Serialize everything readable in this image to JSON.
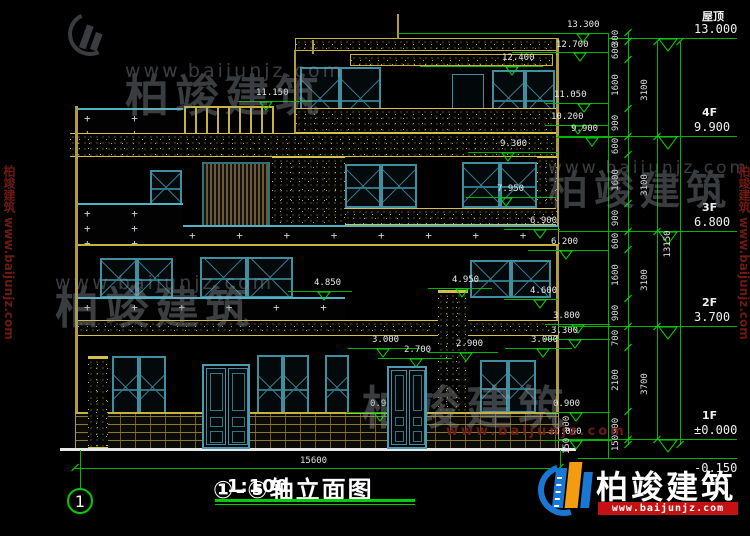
{
  "title_block": {
    "title": "①-⑤轴立面图",
    "scale": "1:100"
  },
  "axis_bubble": {
    "label": "1"
  },
  "bottom_dimension": {
    "label": "15600"
  },
  "pattern_plus": "+",
  "watermark": {
    "cn": "柏竣建筑",
    "url": "www.baijunjz.com"
  },
  "logo": {
    "cn": "柏竣建筑",
    "url": "www.baijunjz.com"
  },
  "colors": {
    "dim_green": "#00b400",
    "cad_yellow": "#b09c3c",
    "window_teal": "#3f8fa0",
    "logo_blue": "#1976d2",
    "logo_orange": "#f39c12",
    "logo_red": "#c41111"
  },
  "annotations": {
    "floor_levels": [
      {
        "name": "屋顶",
        "elev": "13.000",
        "y": 38,
        "lead_x1": 608,
        "tri": true
      },
      {
        "name": "4F",
        "elev": "9.900",
        "y": 136,
        "lead_x1": 558,
        "tri": true
      },
      {
        "name": "3F",
        "elev": "6.800",
        "y": 231,
        "lead_x1": 558,
        "tri": true
      },
      {
        "name": "2F",
        "elev": "3.700",
        "y": 326,
        "lead_x1": 558,
        "tri": true
      },
      {
        "name": "1F",
        "elev": "±0.000",
        "y": 439,
        "lead_x1": 558,
        "tri": true
      },
      {
        "name": "",
        "elev": "-0.150",
        "y": 458,
        "lead_x1": 578,
        "tri": false,
        "below": true
      }
    ],
    "elevation_markers": [
      {
        "l": "13.300",
        "y": 33,
        "x1": 398,
        "x2": 608,
        "tx": 567,
        "ty": 20,
        "mx": 583
      },
      {
        "l": "12.700",
        "y": 52,
        "x1": 512,
        "x2": 608,
        "tx": 556,
        "ty": 40,
        "mx": 580
      },
      {
        "l": "12.400",
        "y": 66,
        "x1": 420,
        "x2": 543,
        "tx": 502,
        "ty": 53,
        "mx": 512
      },
      {
        "l": "11.150",
        "y": 101,
        "x1": 238,
        "x2": 312,
        "tx": 256,
        "ty": 88,
        "mx": 266
      },
      {
        "l": "11.050",
        "y": 103,
        "x1": 545,
        "x2": 608,
        "tx": 554,
        "ty": 90,
        "mx": 584
      },
      {
        "l": "10.200",
        "y": 125,
        "x1": 545,
        "x2": 608,
        "tx": 551,
        "ty": 112,
        "mx": 578
      },
      {
        "l": "9.900",
        "y": 137,
        "x1": 556,
        "x2": 612,
        "tx": 571,
        "ty": 124,
        "mx": 592
      },
      {
        "l": "9.300",
        "y": 152,
        "x1": 468,
        "x2": 558,
        "tx": 500,
        "ty": 139,
        "mx": 508
      },
      {
        "l": "7.950",
        "y": 197,
        "x1": 466,
        "x2": 556,
        "tx": 497,
        "ty": 184,
        "mx": 506
      },
      {
        "l": "6.900",
        "y": 229,
        "x1": 504,
        "x2": 560,
        "tx": 530,
        "ty": 216,
        "mx": 540
      },
      {
        "l": "6.200",
        "y": 250,
        "x1": 528,
        "x2": 608,
        "tx": 551,
        "ty": 237,
        "mx": 566
      },
      {
        "l": "4.950",
        "y": 288,
        "x1": 428,
        "x2": 492,
        "tx": 452,
        "ty": 275,
        "mx": 462
      },
      {
        "l": "4.850",
        "y": 291,
        "x1": 288,
        "x2": 352,
        "tx": 314,
        "ty": 278,
        "mx": 324
      },
      {
        "l": "4.600",
        "y": 299,
        "x1": 504,
        "x2": 558,
        "tx": 530,
        "ty": 286,
        "mx": 540
      },
      {
        "l": "3.800",
        "y": 324,
        "x1": 545,
        "x2": 610,
        "tx": 553,
        "ty": 311,
        "mx": 578
      },
      {
        "l": "3.300",
        "y": 339,
        "x1": 543,
        "x2": 610,
        "tx": 551,
        "ty": 326,
        "mx": 575
      },
      {
        "l": "3.000",
        "y": 348,
        "x1": 348,
        "x2": 420,
        "tx": 372,
        "ty": 335,
        "mx": 383
      },
      {
        "l": "2.900",
        "y": 352,
        "x1": 428,
        "x2": 498,
        "tx": 456,
        "ty": 339,
        "mx": 466
      },
      {
        "l": "2.700",
        "y": 358,
        "x1": 378,
        "x2": 452,
        "tx": 404,
        "ty": 345,
        "mx": 416
      },
      {
        "l": "3.000",
        "y": 348,
        "x1": 505,
        "x2": 572,
        "tx": 531,
        "ty": 335,
        "mx": 543
      },
      {
        "l": "0.900",
        "y": 412,
        "x1": 346,
        "x2": 416,
        "tx": 370,
        "ty": 399,
        "mx": 380
      },
      {
        "l": "0.900",
        "y": 412,
        "x1": 545,
        "x2": 610,
        "tx": 553,
        "ty": 399,
        "mx": 576
      },
      {
        "l": "±0.000",
        "y": 440,
        "x1": 545,
        "x2": 612,
        "tx": 549,
        "ty": 427,
        "mx": 576
      }
    ],
    "dim_chains": [
      {
        "x": 628,
        "tx": 616,
        "boundaries": [
          33,
          42,
          60,
          109,
          137,
          155,
          204,
          232,
          250,
          299,
          327,
          348,
          412,
          440,
          445
        ],
        "labels": [
          "300",
          "600",
          "1600",
          "900",
          "600",
          "1600",
          "900",
          "600",
          "1600",
          "900",
          "700",
          "2100",
          "900",
          "150"
        ]
      },
      {
        "x": 657,
        "tx": 645,
        "boundaries": [
          42,
          137,
          232,
          327,
          440
        ],
        "labels": [
          "3100",
          "3100",
          "3100",
          "3700"
        ]
      },
      {
        "x": 680,
        "tx": 668,
        "boundaries": [
          42,
          445
        ],
        "labels": [
          "13150"
        ]
      }
    ],
    "extra_dim_texts": [
      {
        "t": "900",
        "x": 567,
        "y": 424
      },
      {
        "t": "150",
        "x": 567,
        "y": 446
      }
    ]
  }
}
